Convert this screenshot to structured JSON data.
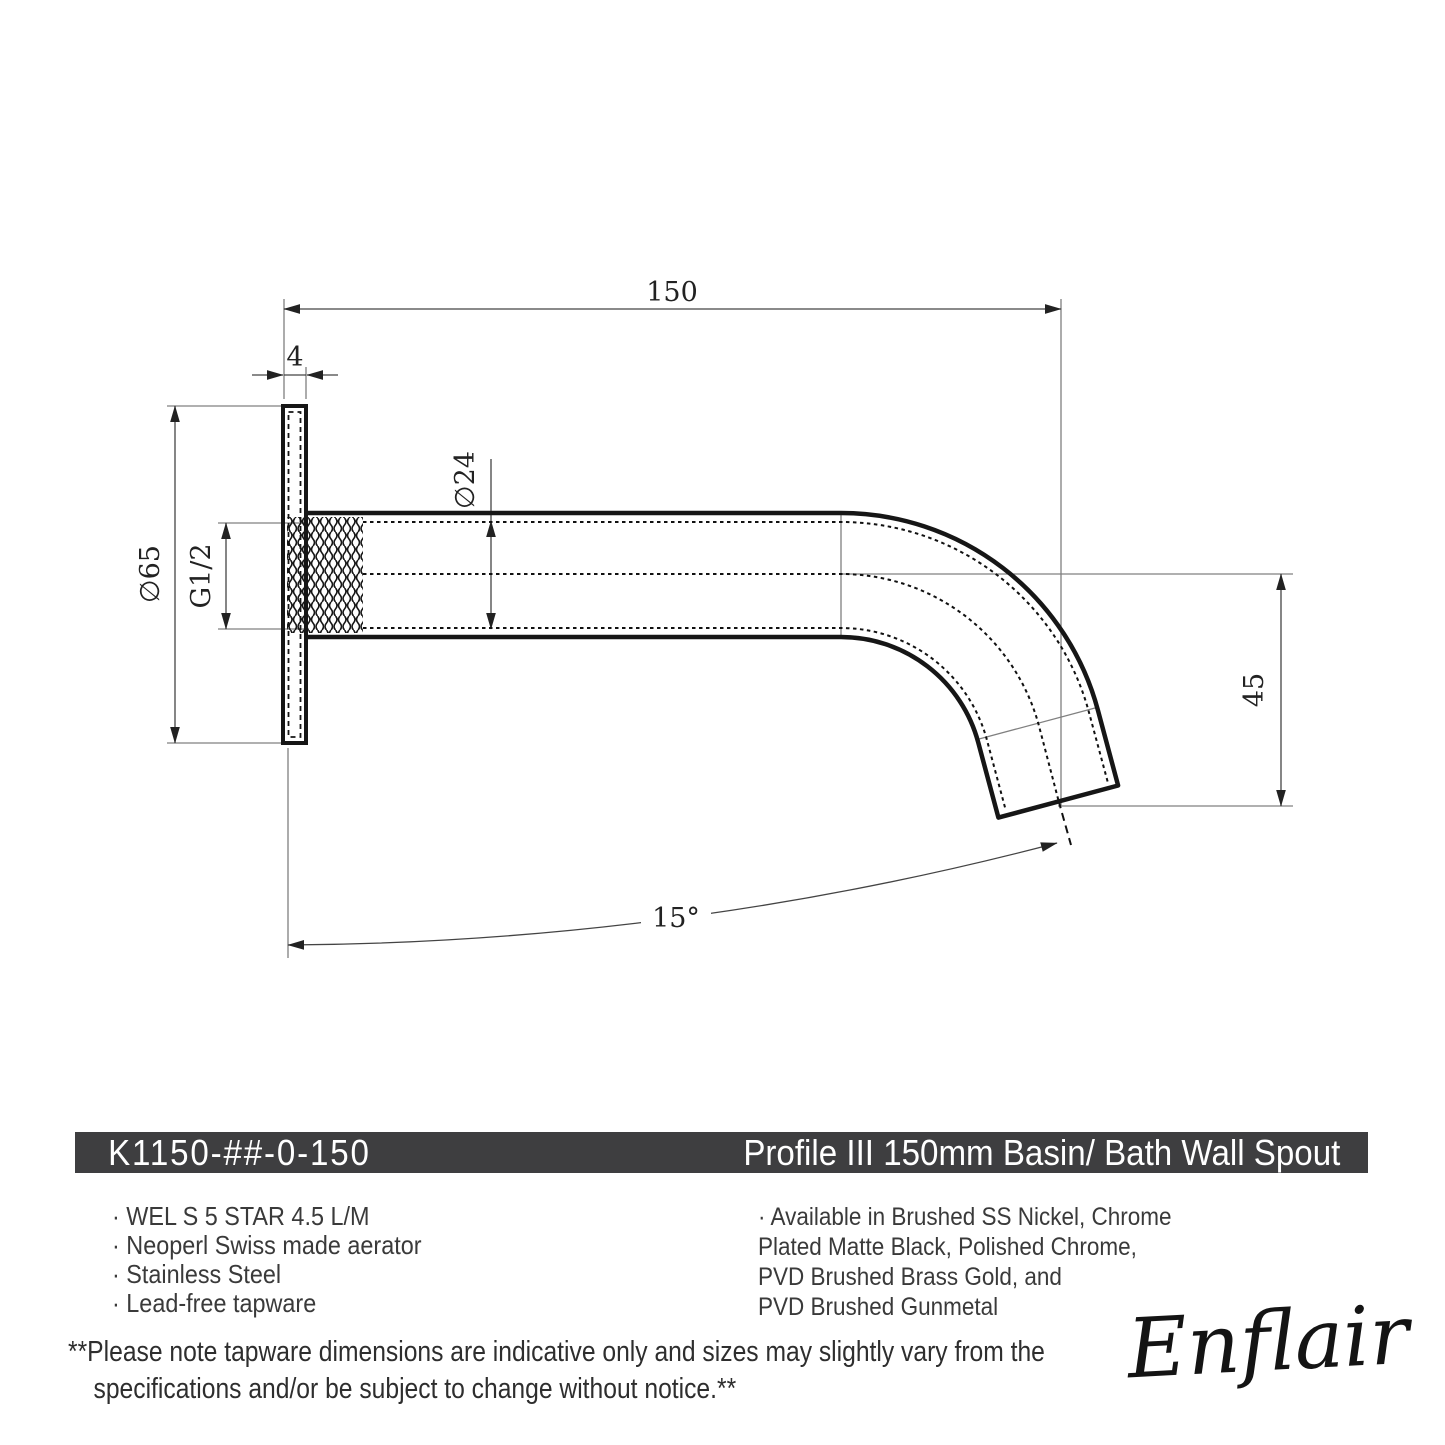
{
  "colors": {
    "outline": "#161616",
    "dim_line": "#444444",
    "ext_line": "#808080",
    "bar_bg": "#3e3e40",
    "bar_text": "#ffffff",
    "body_text": "#3a3a3a"
  },
  "drawing": {
    "dim_length": "150",
    "dim_plate_thickness": "4",
    "dim_spout_diameter": "∅24",
    "dim_flange_diameter": "∅65",
    "dim_thread": "G1/2",
    "dim_drop": "45",
    "dim_angle": "15°"
  },
  "title_bar": {
    "sku": "K1150-##-0-150",
    "name": "Profile III 150mm Basin/ Bath Wall Spout"
  },
  "features": [
    "· WEL S 5 STAR 4.5 L/M",
    "· Neoperl Swiss made aerator",
    "· Stainless Steel",
    "· Lead-free tapware"
  ],
  "finishes": [
    "· Available in Brushed SS Nickel, Chrome",
    "Plated Matte Black, Polished Chrome,",
    "PVD Brushed Brass Gold, and",
    "PVD Brushed Gunmetal"
  ],
  "footnote": [
    "**Please note tapware dimensions are indicative only and sizes may slightly vary from the",
    "specifications and/or be subject to change without notice.**"
  ],
  "brand": "Enflair"
}
